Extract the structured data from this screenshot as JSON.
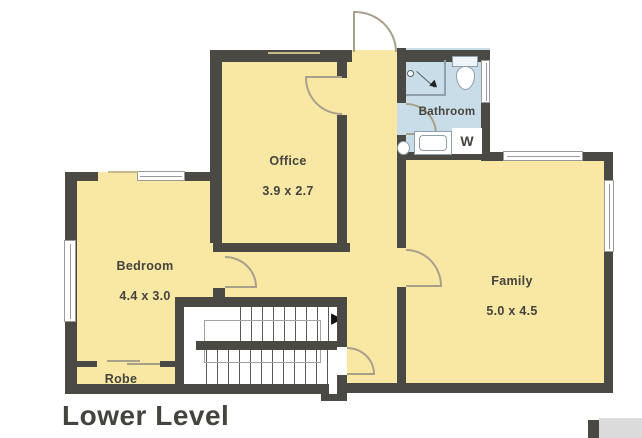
{
  "title": "Lower Level",
  "rooms": {
    "office": {
      "name": "Office",
      "dims": "3.9 x 2.7"
    },
    "bedroom": {
      "name": "Bedroom",
      "dims": "4.4 x 3.0"
    },
    "family": {
      "name": "Family",
      "dims": "5.0 x 4.5"
    },
    "bathroom": {
      "name": "Bathroom"
    },
    "robe": {
      "name": "Robe"
    },
    "laundry": {
      "washer_label": "W"
    }
  },
  "icons": {
    "stair_direction_arrow": "▶"
  },
  "colors": {
    "wall": "#4a4944",
    "floor": "#f8e8a3",
    "bath-floor": "#c9dde9",
    "fixture-line": "#8f9fab",
    "arc": "#a8a08b",
    "sill": "#c6b98b",
    "window-frame": "#9a9a9a",
    "stair-line": "#5a5a56",
    "text": "#44433e",
    "neighbor": "#dbdbdb"
  }
}
